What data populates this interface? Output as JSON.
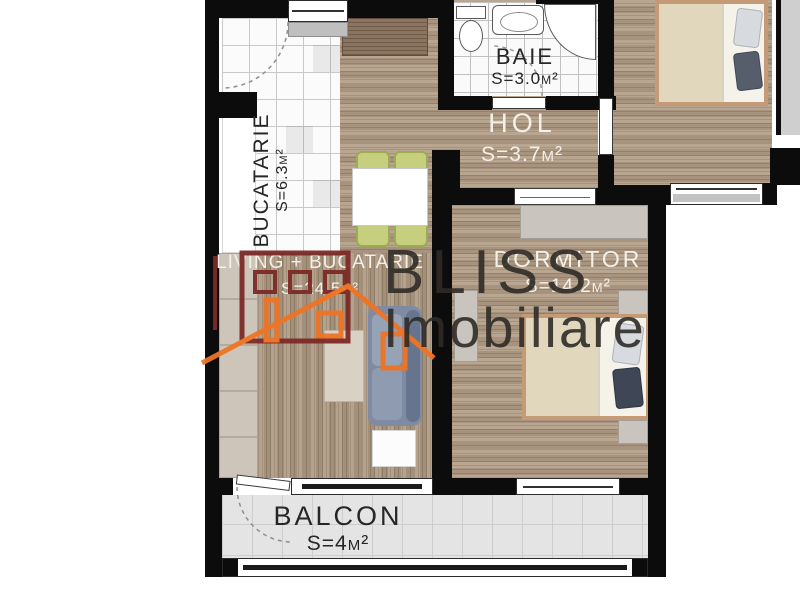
{
  "watermark": {
    "brand": "BLISS",
    "subbrand": "Imobiliare"
  },
  "rooms": {
    "baie": {
      "name": "BAIE",
      "area": "S=3.0m²"
    },
    "hol": {
      "name": "HOL",
      "area": "S=3.7m²"
    },
    "bucatarie": {
      "name": "BUCATARIE",
      "area": "S=6.3m²"
    },
    "living": {
      "name": "LIVING + BUCATARIE",
      "area": "S=24.5m²"
    },
    "dormitor": {
      "name": "DORMITOR",
      "area": "S=14.2m²"
    },
    "balcon": {
      "name": "BALCON",
      "area": "S=4m²"
    }
  },
  "colors": {
    "wall": "#0c0c0c",
    "wood": "#b19c85",
    "logo_red": "#7d2a27",
    "logo_orange": "#ee7425",
    "sofa": "#7e8ba3",
    "chair_green": "#c6cf7d",
    "balcony_tile": "#e4e4e4"
  }
}
